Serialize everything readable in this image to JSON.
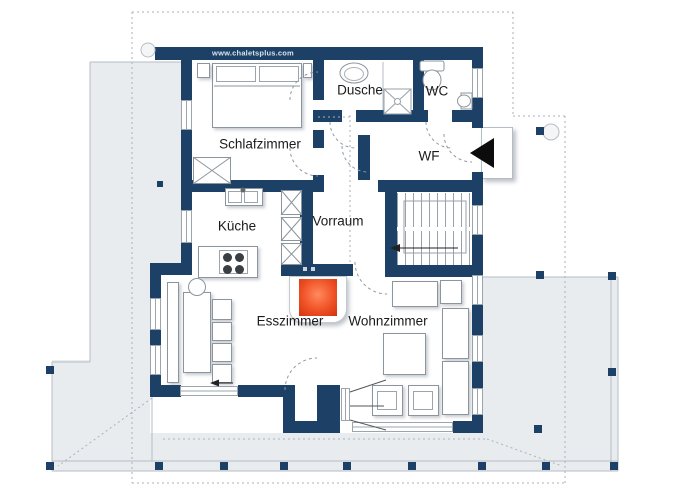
{
  "plan": {
    "watermark": "www.chaletsplus.com"
  },
  "rooms": {
    "schlafzimmer": {
      "label": "Schlafzimmer"
    },
    "dusche": {
      "label": "Dusche"
    },
    "wc": {
      "label": "WC"
    },
    "wf": {
      "label": "WF"
    },
    "kueche": {
      "label": "Küche"
    },
    "vorraum": {
      "label": "Vorraum"
    },
    "esszimmer": {
      "label": "Esszimmer"
    },
    "wohnzimmer": {
      "label": "Wohnzimmer"
    }
  },
  "colors": {
    "wall": "#1c4066",
    "terrace": "#e9ecef",
    "fireplace_core": "#ff8a5e",
    "fireplace_mid": "#f05226",
    "fireplace_edge": "#d2330f",
    "entrance_marker": "#0c0c0c"
  }
}
